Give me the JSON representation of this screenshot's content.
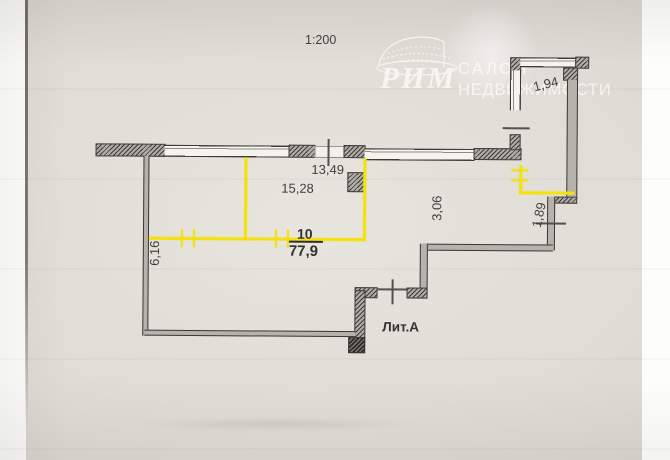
{
  "document": {
    "scale_label": "1:200",
    "building_label": "Лит.А"
  },
  "logo": {
    "brand": "РИМ",
    "tagline_line1": "САЛОН",
    "tagline_line2": "НЕДВИЖИМОСТИ",
    "icon": "colosseum-icon"
  },
  "room": {
    "number": "10",
    "area": "77,9"
  },
  "dimensions": {
    "top": "13,49",
    "room_width": "15,28",
    "inner_right": "3,06",
    "left_side": "6,16",
    "right_step": "1,89",
    "top_right": "1,94"
  },
  "colors": {
    "highlight_yellow": "#f3e20b",
    "wall_dark": "#3b3936",
    "paper": "#ddd9d3"
  }
}
